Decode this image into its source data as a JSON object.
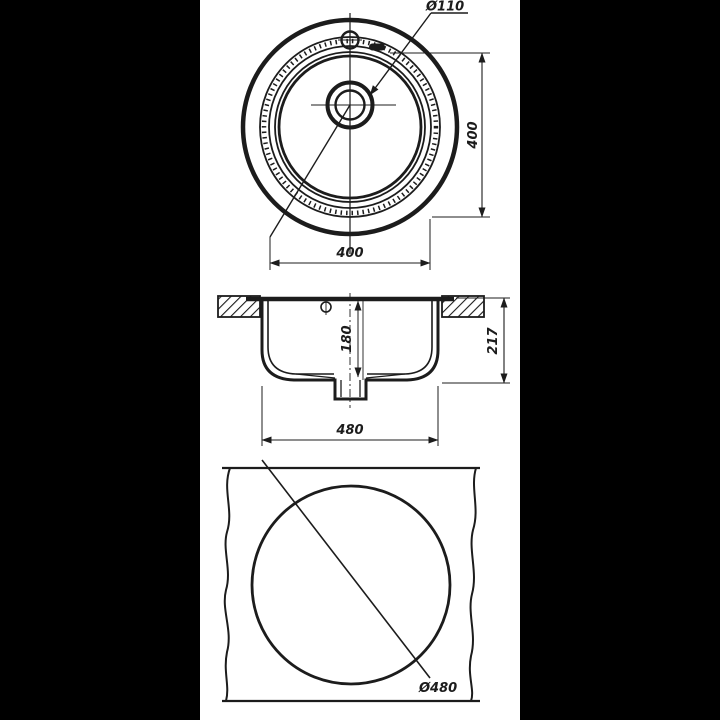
{
  "palette": {
    "background": "#000000",
    "paper": "#ffffff",
    "ink": "#1c1c1c"
  },
  "drawing": {
    "type": "technical-drawing",
    "subject": "round-sink-dimension-drawing",
    "top_view": {
      "drain_diameter_label": "Ø110",
      "bowl_width_label": "400",
      "bowl_height_label": "400"
    },
    "section_view": {
      "bowl_depth_label": "180",
      "overall_height_label": "217",
      "body_width_label": "480"
    },
    "cutout_view": {
      "cutout_diameter_label": "Ø480"
    }
  }
}
